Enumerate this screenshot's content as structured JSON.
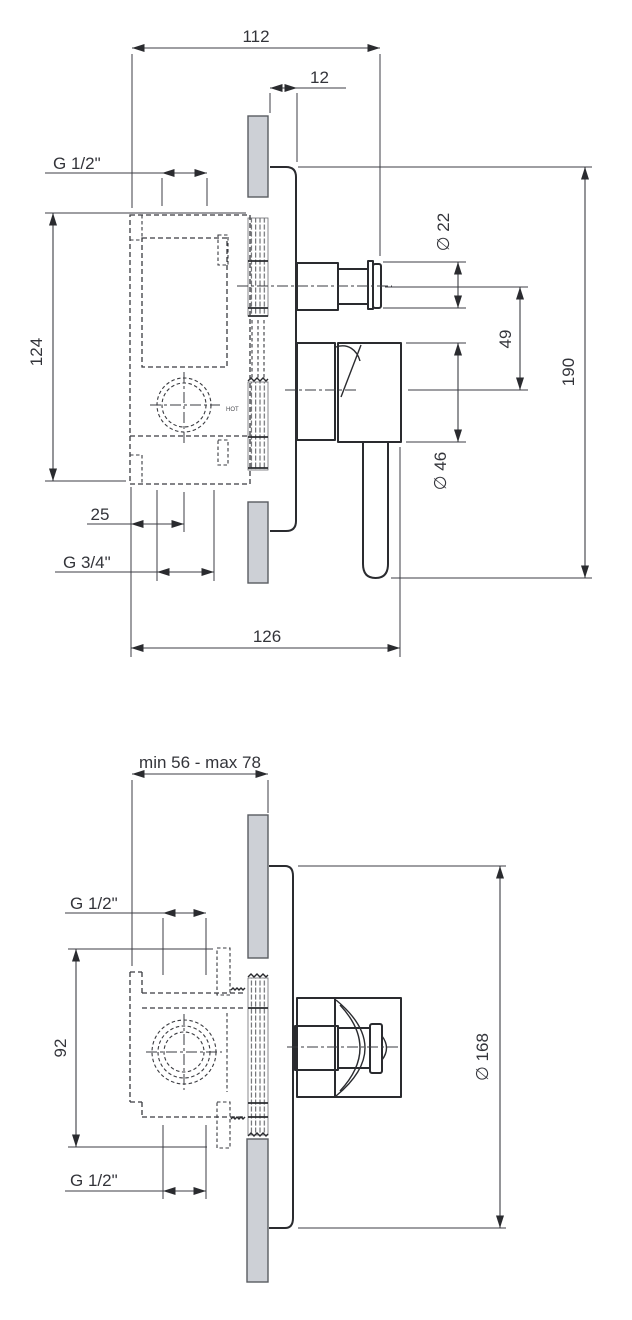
{
  "colors": {
    "line": "#2a2b2f",
    "dim_line": "#3c3e44",
    "wall_fill": "#cdd0d6",
    "text": "#33343a"
  },
  "top_view": {
    "dim_width_body": "112",
    "dim_plate_offset": "12",
    "thread_top": "G 1/2\"",
    "dim_height_body": "124",
    "dim_cartridge_offset": "25",
    "thread_bottom": "G 3/4\"",
    "dim_width_total": "126",
    "dia_spout": "∅ 22",
    "dim_spout_to_handle": "49",
    "dia_handle": "∅ 46",
    "dim_height_total": "190",
    "hot_marking": "HOT"
  },
  "bottom_view": {
    "dim_depth_range": "min 56 - max 78",
    "thread_top": "G 1/2\"",
    "dim_ports_span": "92",
    "thread_bottom": "G 1/2\"",
    "dia_plate": "∅ 168"
  }
}
